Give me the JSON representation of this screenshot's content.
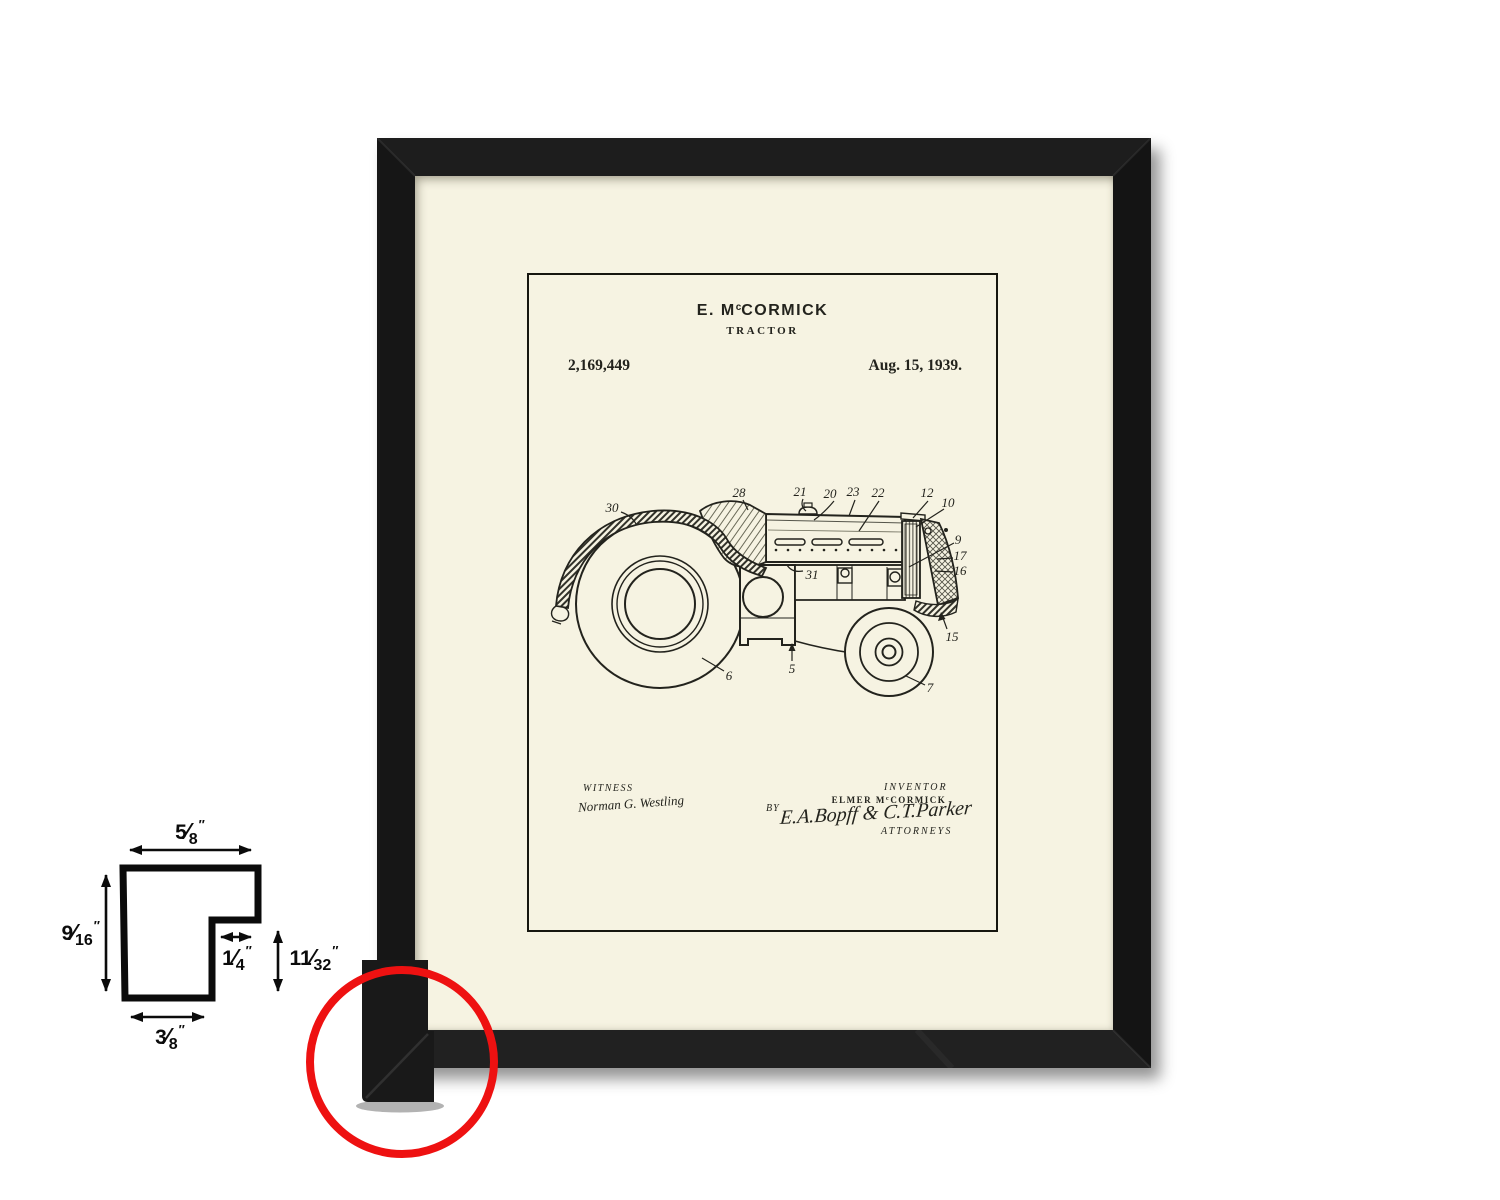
{
  "patent": {
    "header": {
      "title_pre": "E. M",
      "title_sup": "c",
      "title_post": "CORMICK",
      "subtitle": "TRACTOR",
      "number": "2,169,449",
      "date": "Aug. 15, 1939."
    },
    "signatures": {
      "witness_label": "WITNESS",
      "witness_name": "Norman G. Westling",
      "inventor_label": "INVENTOR",
      "inventor_pre": "ELMER M",
      "inventor_sup": "c",
      "inventor_post": "CORMICK",
      "by_label": "BY",
      "attorney_signature": "E.A.Bopff & C.T.Parker",
      "attorneys_label": "ATTORNEYS"
    },
    "refs": {
      "r30": "30",
      "r28": "28",
      "r21": "21",
      "r20": "20",
      "r23": "23",
      "r22": "22",
      "r12": "12",
      "r10": "10",
      "r9": "9",
      "r17": "17",
      "r16": "16",
      "r15": "15",
      "r31": "31",
      "r5": "5",
      "r6": "6",
      "r7": "7"
    }
  },
  "profile_diagram": {
    "top_width": {
      "num": "5",
      "den": "8"
    },
    "left_height": {
      "num": "9",
      "den": "16"
    },
    "rabbet_width": {
      "num": "1",
      "den": "4"
    },
    "rabbet_height": {
      "num": "11",
      "den": "32"
    },
    "bottom_width": {
      "num": "3",
      "den": "8"
    },
    "slash": "⁄",
    "inch_mark": "″"
  },
  "colors": {
    "frame_black": "#191919",
    "mat_cream": "#f6f3e2",
    "ink": "#23231d",
    "highlight_red": "#ee1111",
    "background": "#ffffff"
  }
}
